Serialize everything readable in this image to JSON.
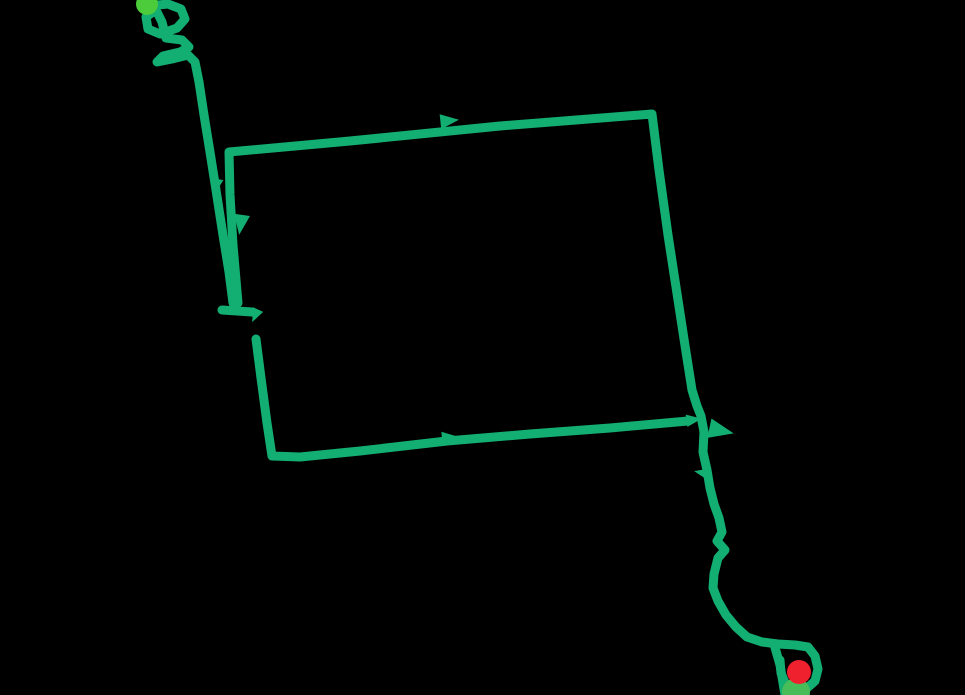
{
  "canvas": {
    "width": 965,
    "height": 695,
    "background": "#000000"
  },
  "route": {
    "stroke_color": "#13AE72",
    "stroke_width": 9,
    "segments": [
      {
        "name": "start-squiggle-and-descent",
        "points": [
          [
            148,
            6
          ],
          [
            168,
            4
          ],
          [
            181,
            9
          ],
          [
            185,
            19
          ],
          [
            177,
            28
          ],
          [
            160,
            34
          ],
          [
            148,
            29
          ],
          [
            146,
            17
          ],
          [
            156,
            10
          ],
          [
            162,
            22
          ],
          [
            166,
            38
          ],
          [
            182,
            40
          ],
          [
            189,
            47
          ],
          [
            180,
            52
          ],
          [
            163,
            56
          ],
          [
            157,
            62
          ],
          [
            172,
            59
          ],
          [
            188,
            55
          ],
          [
            195,
            62
          ],
          [
            199,
            82
          ],
          [
            204,
            115
          ],
          [
            210,
            152
          ],
          [
            216,
            190
          ],
          [
            223,
            235
          ],
          [
            229,
            272
          ],
          [
            233,
            303
          ]
        ]
      },
      {
        "name": "turnaround-cap",
        "points": [
          [
            222,
            310
          ],
          [
            252,
            312
          ]
        ]
      },
      {
        "name": "quad-left-top-right-and-tail",
        "points": [
          [
            238,
            303
          ],
          [
            233,
            245
          ],
          [
            230,
            195
          ],
          [
            229,
            152
          ],
          [
            350,
            141
          ],
          [
            500,
            126
          ],
          [
            652,
            114
          ],
          [
            659,
            170
          ],
          [
            668,
            235
          ],
          [
            678,
            300
          ],
          [
            686,
            352
          ],
          [
            692,
            390
          ],
          [
            697,
            406
          ],
          [
            701,
            416
          ],
          [
            704,
            432
          ],
          [
            703,
            452
          ],
          [
            707,
            470
          ],
          [
            710,
            488
          ],
          [
            714,
            504
          ],
          [
            719,
            518
          ],
          [
            722,
            532
          ],
          [
            717,
            541
          ],
          [
            725,
            550
          ],
          [
            718,
            558
          ],
          [
            714,
            574
          ],
          [
            713,
            588
          ],
          [
            718,
            601
          ],
          [
            726,
            615
          ],
          [
            736,
            627
          ],
          [
            747,
            637
          ],
          [
            762,
            642
          ],
          [
            778,
            644
          ],
          [
            795,
            645
          ],
          [
            808,
            647
          ],
          [
            815,
            656
          ],
          [
            818,
            669
          ],
          [
            815,
            681
          ],
          [
            806,
            689
          ],
          [
            795,
            691
          ],
          [
            786,
            685
          ],
          [
            781,
            673
          ],
          [
            780,
            660
          ]
        ]
      },
      {
        "name": "end-loop-left-branch",
        "points": [
          [
            774,
            644
          ],
          [
            780,
            665
          ],
          [
            785,
            695
          ]
        ]
      },
      {
        "name": "resume-after-gap-bottom-edge",
        "points": [
          [
            256,
            339
          ],
          [
            261,
            378
          ],
          [
            267,
            423
          ],
          [
            272,
            456
          ],
          [
            300,
            457
          ],
          [
            360,
            451
          ],
          [
            447,
            441
          ],
          [
            530,
            434
          ],
          [
            610,
            428
          ],
          [
            688,
            421
          ]
        ]
      }
    ],
    "direction_arrows": [
      {
        "name": "arrow-left-descent",
        "x": 217,
        "y": 184,
        "angle": 100,
        "size": 9
      },
      {
        "name": "arrow-quad-left-edge",
        "x": 241,
        "y": 222,
        "angle": 98,
        "size": 13
      },
      {
        "name": "arrow-top-edge",
        "x": 447,
        "y": 121,
        "angle": -6,
        "size": 12
      },
      {
        "name": "arrow-bottom-edge",
        "x": 448,
        "y": 438,
        "angle": -5,
        "size": 11
      },
      {
        "name": "arrow-bottom-edge-terminus",
        "x": 692,
        "y": 420,
        "angle": -8,
        "size": 10
      },
      {
        "name": "arrow-corner-junction",
        "x": 718,
        "y": 430,
        "angle": 12,
        "size": 16
      },
      {
        "name": "arrow-tail-kink",
        "x": 703,
        "y": 473,
        "angle": 192,
        "size": 9
      },
      {
        "name": "arrow-cap-end",
        "x": 256,
        "y": 314,
        "angle": 115,
        "size": 9
      }
    ]
  },
  "markers": [
    {
      "name": "start-marker",
      "x": 147,
      "y": 4,
      "r": 11,
      "color": "#4CCB3B"
    },
    {
      "name": "end-marker-secondary",
      "x": 796,
      "y": 692,
      "r": 14,
      "color": "#46BD58"
    },
    {
      "name": "end-marker",
      "x": 799,
      "y": 672,
      "r": 12,
      "color": "#F0212E"
    }
  ]
}
